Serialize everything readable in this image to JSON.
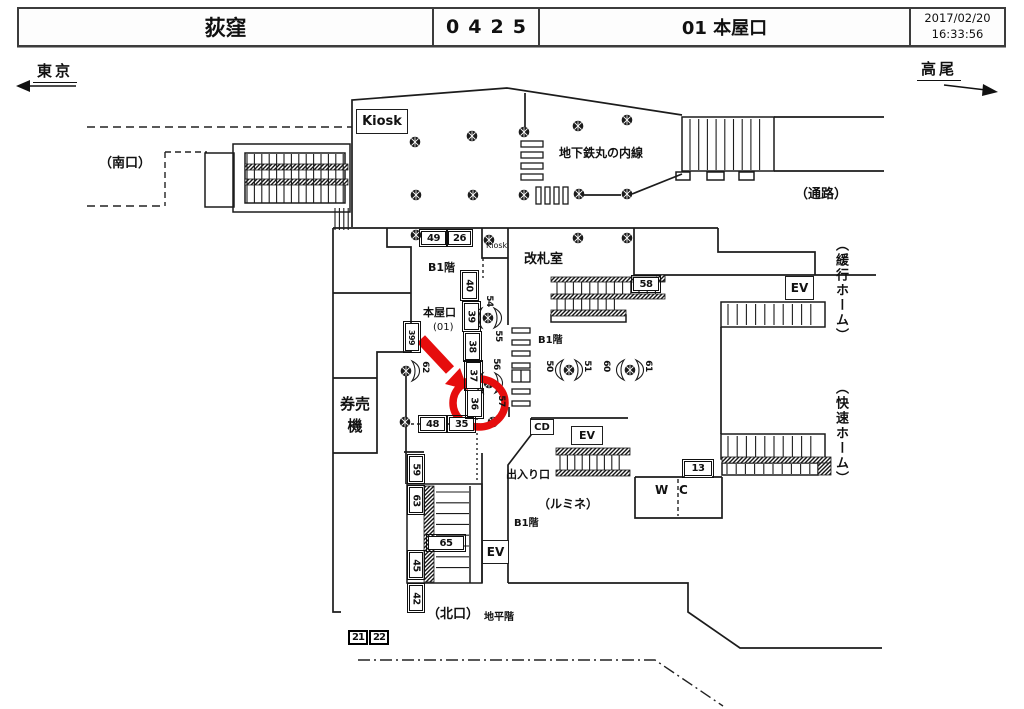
{
  "header": {
    "station": "荻窪",
    "code": "0425",
    "entrance": "01 本屋口",
    "date": "2017/02/20",
    "time": "16:33:56"
  },
  "directions": {
    "left": "東京",
    "right": "高尾"
  },
  "colors": {
    "highlight": "#e60d0d",
    "line": "#1c1c1c"
  },
  "map": {
    "labels": [
      {
        "name": "label-south-exit",
        "text": "（南口）",
        "x": 99,
        "y": 157,
        "fs": 13,
        "bold": true
      },
      {
        "name": "label-marunouchi-line",
        "text": "地下鉄丸の内線",
        "x": 559,
        "y": 147,
        "fs": 12,
        "bold": true
      },
      {
        "name": "label-passage",
        "text": "（通路）",
        "x": 795,
        "y": 188,
        "fs": 13,
        "bold": true
      },
      {
        "name": "label-kiosk-small",
        "text": "Kiosk",
        "x": 486,
        "y": 241,
        "fs": 8,
        "bold": false
      },
      {
        "name": "label-gate-office",
        "text": "改札室",
        "x": 524,
        "y": 253,
        "fs": 13,
        "bold": true
      },
      {
        "name": "label-b1-west",
        "text": "B1階",
        "x": 428,
        "y": 262,
        "fs": 11,
        "bold": true
      },
      {
        "name": "label-b1-center",
        "text": "B1階",
        "x": 538,
        "y": 335,
        "fs": 10,
        "bold": true
      },
      {
        "name": "label-b1-south",
        "text": "B1階",
        "x": 514,
        "y": 518,
        "fs": 10,
        "bold": true
      },
      {
        "name": "label-honyaguchi",
        "text": "本屋口",
        "x": 423,
        "y": 307,
        "fs": 11,
        "bold": true
      },
      {
        "name": "label-honyaguchi-no",
        "text": "(01)",
        "x": 433,
        "y": 322,
        "fs": 10,
        "bold": false
      },
      {
        "name": "label-ticket-machines",
        "text": "券売機",
        "x": 337,
        "y": 394,
        "fs": 15,
        "bold": true,
        "id": "kenbaiki"
      },
      {
        "name": "label-exit-entrance",
        "text": "出入り口",
        "x": 506,
        "y": 469,
        "fs": 11,
        "bold": true
      },
      {
        "name": "label-lumine",
        "text": "（ルミネ）",
        "x": 538,
        "y": 498,
        "fs": 12,
        "bold": true
      },
      {
        "name": "label-north-exit",
        "text": "（北口）",
        "x": 427,
        "y": 608,
        "fs": 13,
        "bold": true
      },
      {
        "name": "label-ground-level",
        "text": "地平階",
        "x": 484,
        "y": 612,
        "fs": 10,
        "bold": true
      },
      {
        "name": "label-wc-w",
        "text": "W",
        "x": 655,
        "y": 484,
        "fs": 12,
        "bold": true
      },
      {
        "name": "label-wc-c",
        "text": "C",
        "x": 679,
        "y": 484,
        "fs": 12,
        "bold": true
      },
      {
        "name": "label-local-platform",
        "text": "（緩行ホーム）",
        "x": 832,
        "y": 238,
        "fs": 13,
        "bold": true,
        "vert": true
      },
      {
        "name": "label-rapid-platform",
        "text": "（快速ホーム）",
        "x": 832,
        "y": 381,
        "fs": 13,
        "bold": true,
        "vert": true
      }
    ],
    "boxed_labels": [
      {
        "name": "kiosk-box",
        "text": "Kiosk",
        "x": 356,
        "y": 109,
        "w": 52,
        "h": 25,
        "fs": 13
      },
      {
        "name": "ev-upper-right",
        "text": "EV",
        "x": 785,
        "y": 276,
        "w": 29,
        "h": 24,
        "fs": 12
      },
      {
        "name": "ev-center",
        "text": "EV",
        "x": 571,
        "y": 426,
        "w": 32,
        "h": 19,
        "fs": 11
      },
      {
        "name": "ev-lower-left",
        "text": "EV",
        "x": 482,
        "y": 540,
        "w": 27,
        "h": 24,
        "fs": 12
      },
      {
        "name": "cd-box",
        "text": "CD",
        "x": 530,
        "y": 419,
        "w": 24,
        "h": 16,
        "fs": 10
      }
    ],
    "num_boxes": [
      {
        "text": "49",
        "x": 421,
        "y": 231,
        "w": 25,
        "h": 14
      },
      {
        "text": "26",
        "x": 448,
        "y": 231,
        "w": 23,
        "h": 14
      },
      {
        "text": "48",
        "x": 420,
        "y": 417,
        "w": 25,
        "h": 14
      },
      {
        "text": "35",
        "x": 449,
        "y": 417,
        "w": 25,
        "h": 14
      },
      {
        "text": "65",
        "x": 428,
        "y": 536,
        "w": 36,
        "h": 14
      },
      {
        "text": "58",
        "x": 633,
        "y": 277,
        "w": 26,
        "h": 14
      },
      {
        "text": "13",
        "x": 684,
        "y": 461,
        "w": 28,
        "h": 15
      },
      {
        "text": "21",
        "x": 348,
        "y": 630,
        "w": 20,
        "h": 15,
        "thick": true
      },
      {
        "text": "22",
        "x": 369,
        "y": 630,
        "w": 20,
        "h": 15,
        "thick": true
      }
    ],
    "v_num_boxes": [
      {
        "text": "40",
        "x": 462,
        "y": 272,
        "w": 15,
        "h": 27
      },
      {
        "text": "39",
        "x": 464,
        "y": 303,
        "w": 15,
        "h": 27
      },
      {
        "text": "38",
        "x": 465,
        "y": 333,
        "w": 15,
        "h": 27
      },
      {
        "text": "37",
        "x": 466,
        "y": 362,
        "w": 15,
        "h": 27
      },
      {
        "text": "36",
        "x": 467,
        "y": 390,
        "w": 15,
        "h": 27
      },
      {
        "text": "399",
        "x": 405,
        "y": 323,
        "w": 14,
        "h": 28
      },
      {
        "text": "59",
        "x": 409,
        "y": 456,
        "w": 14,
        "h": 26
      },
      {
        "text": "63",
        "x": 409,
        "y": 487,
        "w": 14,
        "h": 26
      },
      {
        "text": "45",
        "x": 409,
        "y": 552,
        "w": 14,
        "h": 26
      },
      {
        "text": "42",
        "x": 409,
        "y": 585,
        "w": 14,
        "h": 26
      }
    ],
    "camera_dots": [
      {
        "x": 415,
        "y": 142
      },
      {
        "x": 472,
        "y": 136
      },
      {
        "x": 524,
        "y": 132
      },
      {
        "x": 578,
        "y": 126
      },
      {
        "x": 627,
        "y": 120
      },
      {
        "x": 416,
        "y": 195
      },
      {
        "x": 473,
        "y": 195
      },
      {
        "x": 524,
        "y": 195
      },
      {
        "x": 579,
        "y": 194
      },
      {
        "x": 627,
        "y": 194
      },
      {
        "x": 578,
        "y": 238
      },
      {
        "x": 627,
        "y": 238
      },
      {
        "x": 416,
        "y": 235
      },
      {
        "x": 489,
        "y": 240
      },
      {
        "x": 405,
        "y": 422
      },
      {
        "x": 493,
        "y": 422
      }
    ],
    "wing_cameras": [
      {
        "name": "camera-54-55",
        "x": 488,
        "y": 318,
        "wings": [
          "left",
          "right"
        ],
        "labels": [
          {
            "text": "54",
            "x": 484,
            "y": 296
          },
          {
            "text": "55",
            "x": 493,
            "y": 331
          }
        ]
      },
      {
        "name": "camera-56-57",
        "x": 489,
        "y": 383,
        "wings": [
          "left",
          "right"
        ],
        "labels": [
          {
            "text": "56",
            "x": 491,
            "y": 359
          },
          {
            "text": "57",
            "x": 496,
            "y": 396
          }
        ]
      },
      {
        "name": "camera-50-51",
        "x": 569,
        "y": 370,
        "wings": [
          "left",
          "right"
        ],
        "labels": [
          {
            "text": "50",
            "x": 544,
            "y": 361
          },
          {
            "text": "51",
            "x": 582,
            "y": 361
          }
        ]
      },
      {
        "name": "camera-60-61",
        "x": 630,
        "y": 370,
        "wings": [
          "left",
          "right"
        ],
        "labels": [
          {
            "text": "60",
            "x": 601,
            "y": 361
          },
          {
            "text": "61",
            "x": 643,
            "y": 361
          }
        ]
      },
      {
        "name": "camera-62",
        "x": 406,
        "y": 371,
        "wings": [
          "right"
        ],
        "labels": [
          {
            "text": "62",
            "x": 420,
            "y": 362
          }
        ]
      }
    ],
    "highlight": {
      "target": "36"
    }
  }
}
